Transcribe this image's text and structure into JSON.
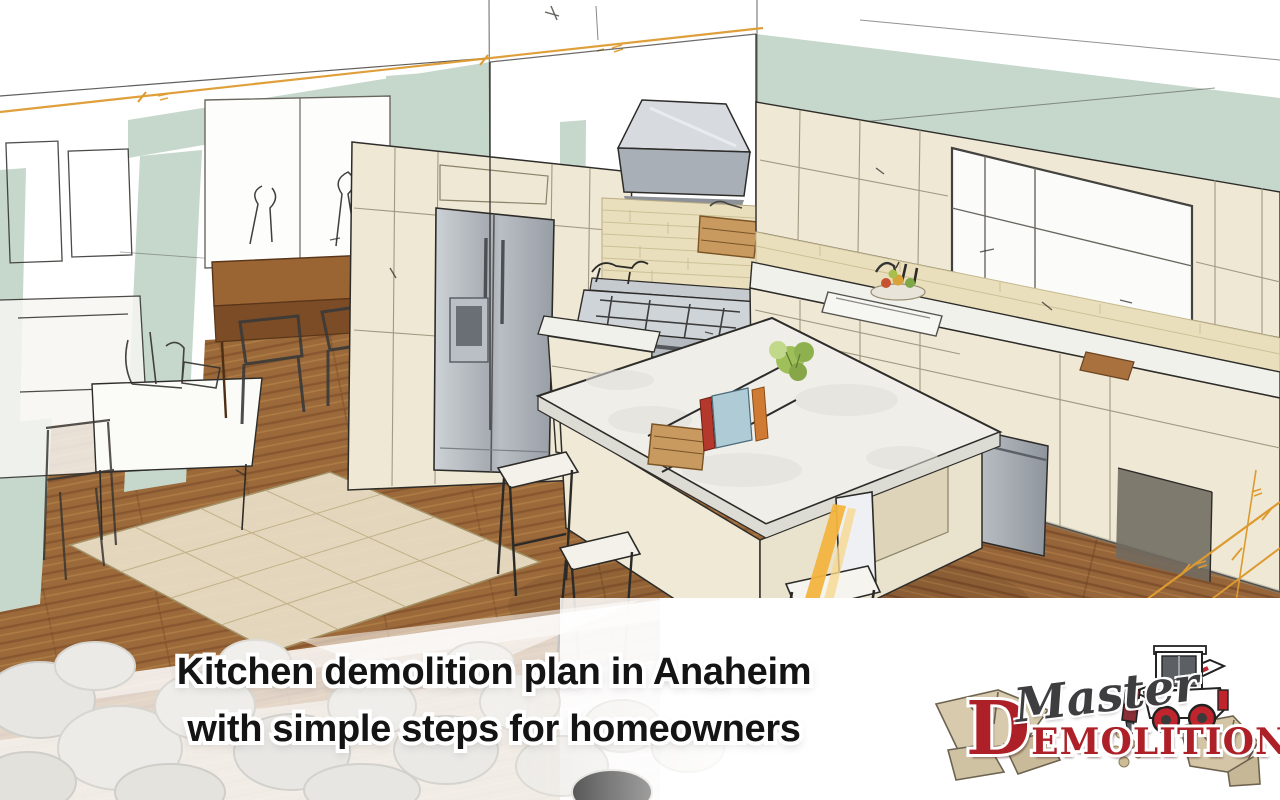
{
  "hero": {
    "title_line1": "Kitchen demolition plan in Anaheim",
    "title_line2": "with simple steps for homeowners"
  },
  "logo": {
    "script_text": "Master",
    "initial": "D",
    "block_rest": "EMOLITION"
  },
  "illustration": {
    "alt": "Hand-drawn watercolor sketch of a kitchen interior with sage green walls, cream cabinets, stainless refrigerator, range hood, stove, center island with bar stools and wood plank floor, marked with orange dimension lines"
  },
  "colors": {
    "sage_wall": "#c6d8cb",
    "cream_cabinet": "#efe8d5",
    "wood_floor": "#9c6a3a",
    "marble_counter": "#efeeea",
    "stainless": "#a9afb5",
    "dimension_orange": "#dd9a30",
    "highlight_yellow": "#f2b43e",
    "logo_red": "#ae2028",
    "heading_text": "#141414",
    "overlay_white": "#ffffff"
  }
}
